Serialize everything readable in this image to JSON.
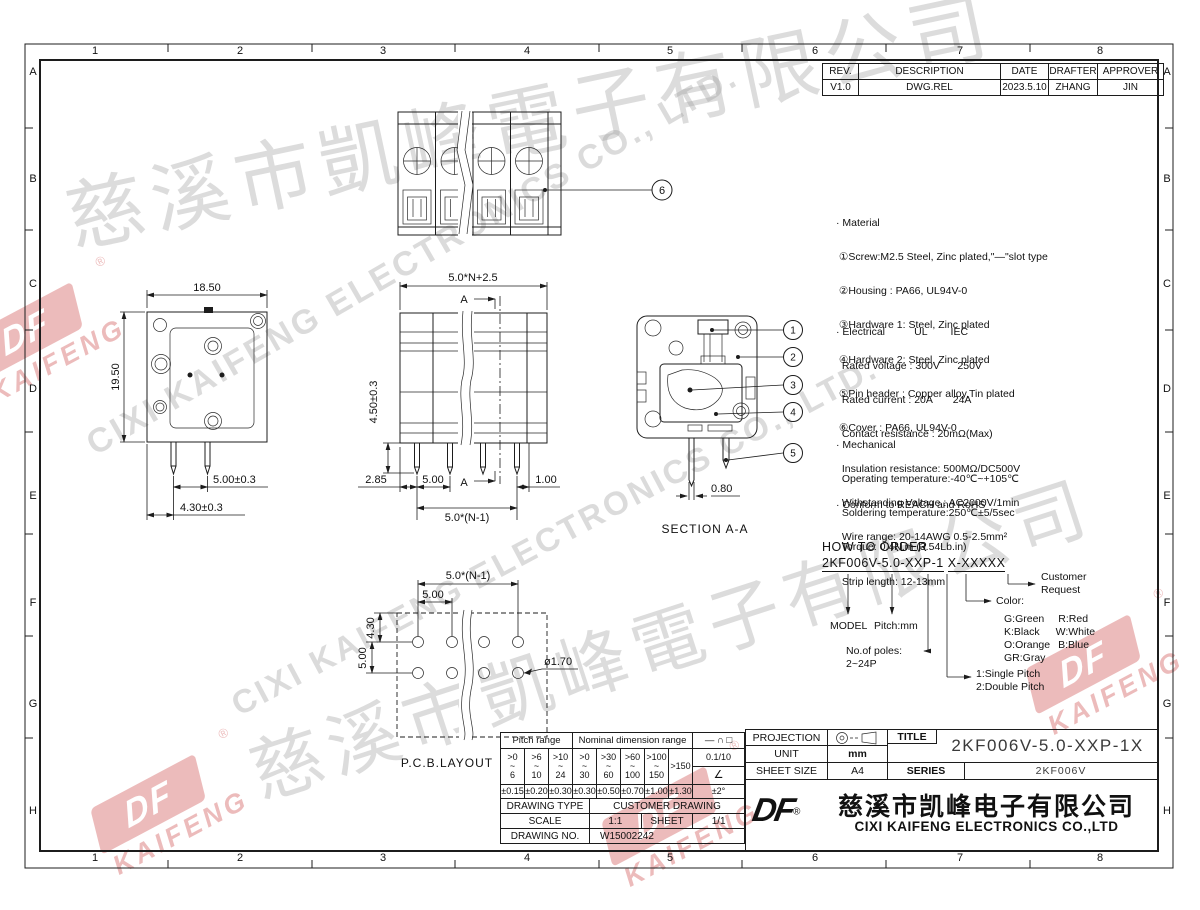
{
  "frame": {
    "zones_h": [
      "1",
      "2",
      "3",
      "4",
      "5",
      "6",
      "7",
      "8"
    ],
    "zones_v": [
      "A",
      "B",
      "C",
      "D",
      "E",
      "F",
      "G",
      "H"
    ]
  },
  "revision_table": {
    "headers": [
      "REV.",
      "DESCRIPTION",
      "DATE",
      "DRAFTER",
      "APPROVER"
    ],
    "row": [
      "V1.0",
      "DWG.REL",
      "2023.5.10",
      "ZHANG",
      "JIN"
    ]
  },
  "notes": {
    "material": {
      "title": "· Material",
      "lines": [
        " ①Screw:M2.5 Steel, Zinc plated,\"—\"slot type",
        " ②Housing : PA66, UL94V-0",
        " ③Hardware 1: Steel, Zinc plated",
        " ④Hardware 2: Steel, Zinc plated",
        " ⑤Pin header : Copper alloy,Tin plated",
        " ⑥Cover : PA66, UL94V-0"
      ]
    },
    "electrical": {
      "header": "· Electrical          UL        IEC",
      "lines": [
        "  Rated voltage : 300V      250V",
        "  Rated current : 20A       24A",
        "  Contact resistance : 20mΩ(Max)",
        "  Insulation resistance: 500MΩ/DC500V",
        "  Withstanding Voltage : AC2000V/1min",
        "  Wire range: 20-14AWG 0.5-2.5mm²"
      ]
    },
    "mechanical": {
      "title": "· Mechanical",
      "lines": [
        "  Operating temperature:-40℃~+105℃",
        "  Soldering temperature:250℃±5/5sec",
        "  Torque: 0.4N.m (3.54Lb.in)",
        "  Strip length: 12-13mm"
      ]
    },
    "compliance": "· Conform to REACH and RoHS"
  },
  "order": {
    "title": "HOW TO ORDER",
    "code_main": "2KF006V-5.0-XXP-1",
    "code_suffix": "X-XXXXX",
    "model": "MODEL",
    "pitch": "Pitch:mm",
    "poles_label": "No.of poles:",
    "poles_range": "2~24P",
    "pitch1": "1:Single Pitch",
    "pitch2": "2:Double Pitch",
    "color_label": "Color:",
    "colors": [
      [
        "G:Green",
        "R:Red"
      ],
      [
        "K:Black",
        "W:White"
      ],
      [
        "O:Orange",
        "B:Blue"
      ],
      [
        "GR:Gray",
        ""
      ]
    ],
    "customer1": "Customer",
    "customer2": "Request"
  },
  "views": {
    "front": {
      "callout": "6"
    },
    "side": {
      "dim_width": "18.50",
      "dim_height": "19.50",
      "dim_pin_pitch": "5.00±0.3",
      "dim_pin_offset": "4.30±0.3"
    },
    "rear": {
      "dim_total": "5.0*N+2.5",
      "dim_h": "4.50±0.3",
      "dim_a": "2.85",
      "dim_b": "5.00",
      "dim_c": "1.00",
      "dim_span": "5.0*(N-1)",
      "section_mark": "A"
    },
    "section": {
      "callouts": [
        "1",
        "2",
        "3",
        "4",
        "5"
      ],
      "dim_pin": "0.80",
      "label": "SECTION A-A"
    },
    "pcb": {
      "dim_span": "5.0*(N-1)",
      "dim_pitch": "5.00",
      "dim_row1": "4.30",
      "dim_row2": "5.00",
      "dim_hole": "ø1.70",
      "label": "P.C.B.LAYOUT"
    }
  },
  "tolerance_table": {
    "pitch_header": "Pitch range",
    "nominal_header": "Nominal dimension range",
    "symbols": "— ∩ □",
    "ranges": [
      ">0\n~\n6",
      ">6\n~\n10",
      ">10\n~\n24",
      ">0\n~\n30",
      ">30\n~\n60",
      ">60\n~\n100",
      ">100\n~\n150",
      ">150"
    ],
    "tolerances": [
      "±0.15",
      "±0.20",
      "±0.30",
      "±0.30",
      "±0.50",
      "±0.70",
      "±1.00",
      "±1.30"
    ],
    "ratio": "0.1/10",
    "angle_symbol": "∠",
    "angle_tol": "±2°"
  },
  "info_table": {
    "drawing_type_label": "DRAWING TYPE",
    "drawing_type": "CUSTOMER DRAWING",
    "scale_label": "SCALE",
    "scale": "1:1",
    "sheet_label": "SHEET",
    "sheet": "1/1",
    "drawing_no_label": "DRAWING NO.",
    "drawing_no": "W15002242"
  },
  "title_block": {
    "projection_label": "PROJECTION",
    "unit_label": "UNIT",
    "unit": "mm",
    "sheet_size_label": "SHEET SIZE",
    "sheet_size": "A4",
    "title_label": "TITLE",
    "title": "2KF006V-5.0-XXP-1X",
    "series_label": "SERIES",
    "series": "2KF006V"
  },
  "company": {
    "logo": "DF",
    "reg": "®",
    "name_cn": "慈溪市凯峰电子有限公司",
    "name_en": "CIXI KAIFENG ELECTRONICS CO.,LTD"
  },
  "watermark": {
    "cn": "慈溪市凱峰電子有限公司",
    "en": "CIXI KAIFENG ELECTRONICS CO., LTD.",
    "logo_text": "DF",
    "logo_sub": "KAIFENG"
  }
}
